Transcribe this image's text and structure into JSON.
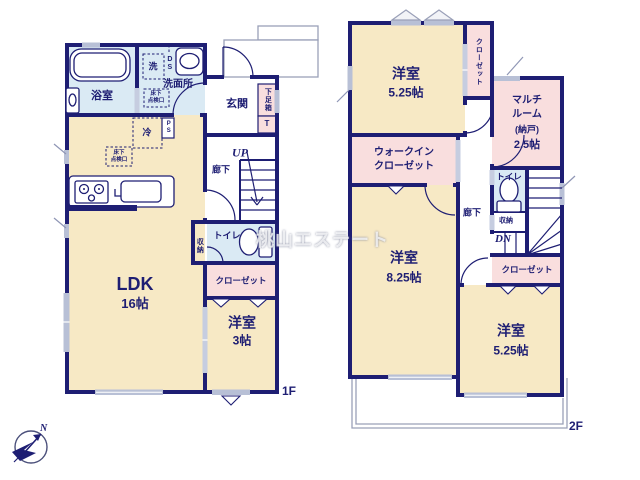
{
  "watermark_text": "桃山エステート",
  "compass_north_label": "N",
  "colors": {
    "wall_navy": "#1e1e73",
    "room_cream": "#f7e9c5",
    "closet_pink": "#f9dede",
    "wet_area_blue": "#daeaf4",
    "window_gray": "#b8c0d6"
  },
  "floor1": {
    "floor_label": "1F",
    "stairs_label": "UP",
    "rooms": {
      "bath": "浴室",
      "washroom": "洗面所",
      "entrance": "玄関",
      "hallway": "廊下",
      "ldk_name": "LDK",
      "ldk_size": "16帖",
      "toilet": "トイレ",
      "storage": "収納",
      "closet": "クローゼット",
      "bedroom_name": "洋室",
      "bedroom_size": "3帖",
      "shoe_cabinet": "下足箱",
      "shoe_cabinet_t": "T"
    },
    "fixtures": {
      "washer": "洗",
      "duct_space": "DS",
      "pipe_space": "PS",
      "refrigerator": "冷",
      "floor_hatch_line1": "床下",
      "floor_hatch_line2": "点検口"
    }
  },
  "floor2": {
    "floor_label": "2F",
    "stairs_label": "DN",
    "rooms": {
      "bedroom_a_name": "洋室",
      "bedroom_a_size": "5.25帖",
      "closet_top": "クローゼット",
      "multi_line1": "マルチ",
      "multi_line2": "ルーム",
      "multi_line3": "(納戸)",
      "multi_line4": "2.5帖",
      "wic_line1": "ウォークイン",
      "wic_line2": "クローゼット",
      "hallway": "廊下",
      "toilet": "トイレ",
      "storage": "収納",
      "closet_bottom": "クローゼット",
      "bedroom_b_name": "洋室",
      "bedroom_b_size": "8.25帖",
      "bedroom_c_name": "洋室",
      "bedroom_c_size": "5.25帖"
    }
  }
}
